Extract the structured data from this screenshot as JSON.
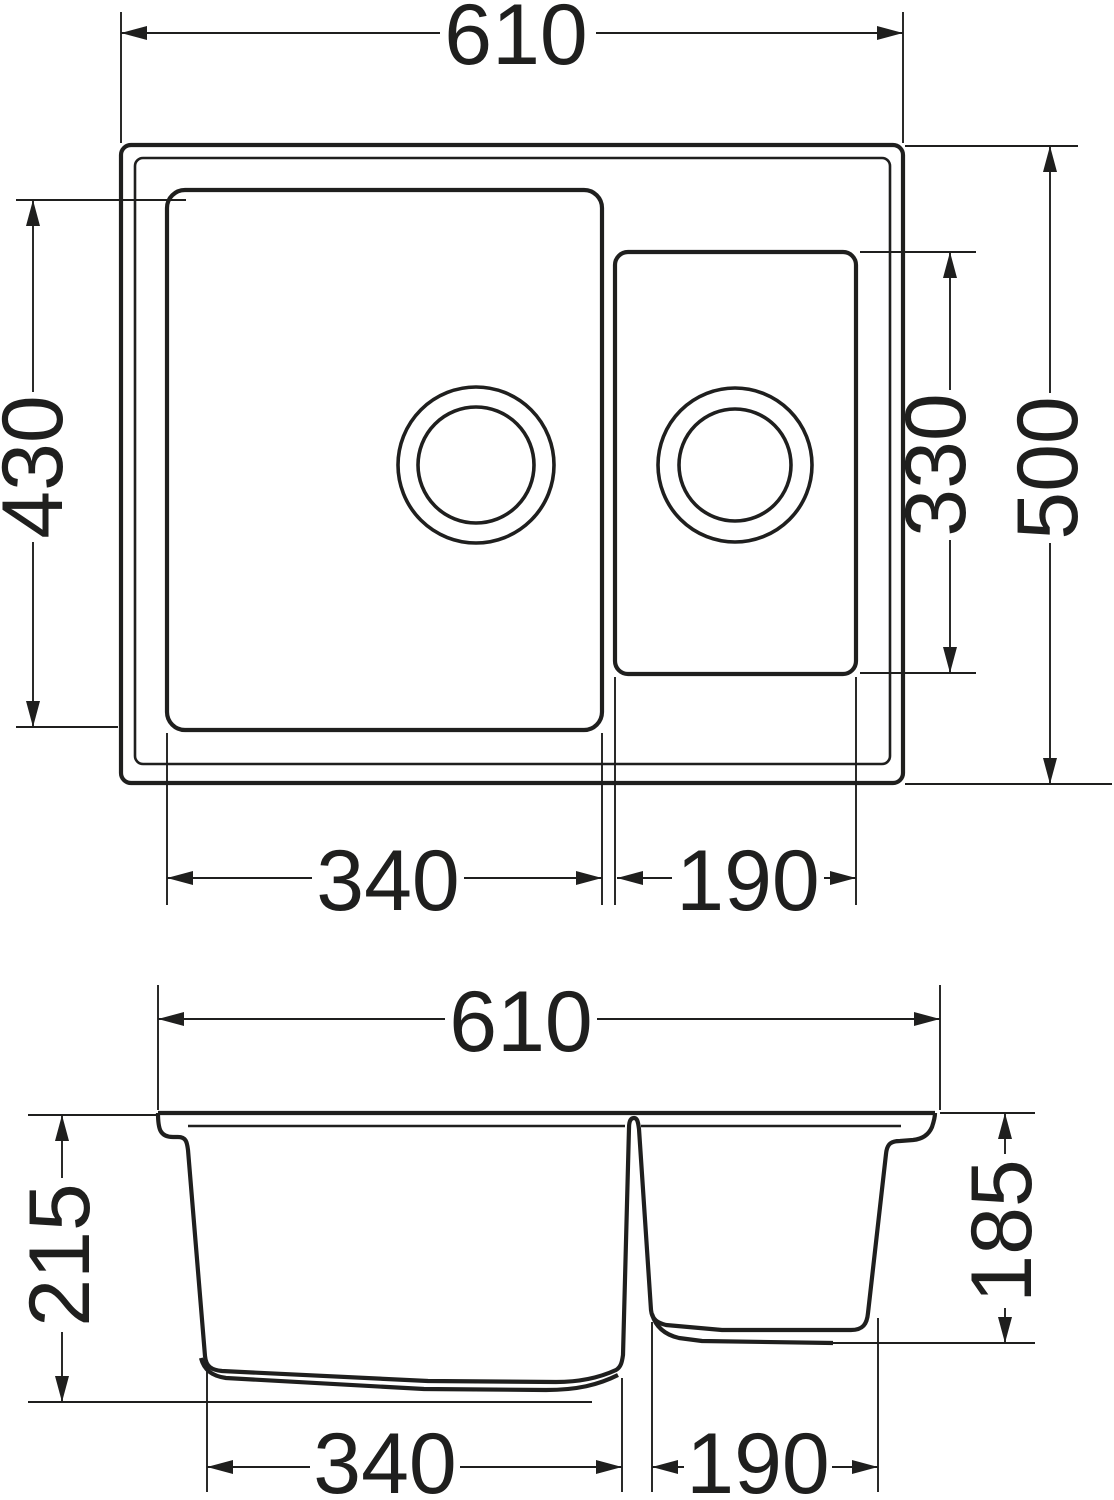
{
  "views": {
    "top": {
      "dims": {
        "overall_width": "610",
        "overall_depth": "500",
        "main_bowl_length": "430",
        "half_bowl_length": "330",
        "main_bowl_width": "340",
        "half_bowl_width": "190"
      }
    },
    "front": {
      "dims": {
        "overall_width": "610",
        "main_bowl_depth": "215",
        "half_bowl_depth": "185",
        "main_bowl_width": "340",
        "half_bowl_width": "190"
      }
    }
  },
  "colors": {
    "line": "#1f1f1e",
    "background": "#ffffff"
  }
}
